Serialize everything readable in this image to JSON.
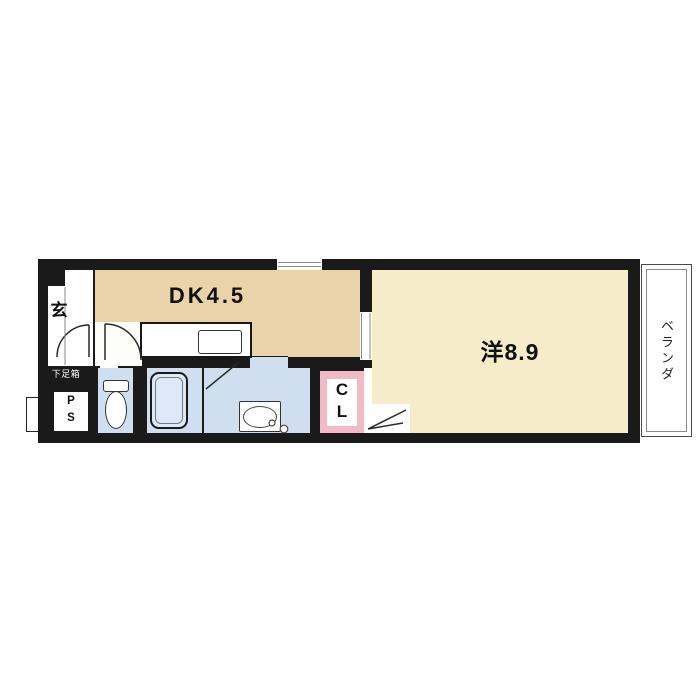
{
  "floorplan": {
    "rooms": {
      "genkan": {
        "label": "玄"
      },
      "dining_kitchen": {
        "label": "DK4.5"
      },
      "western_room": {
        "label": "洋8.9"
      },
      "veranda": {
        "label": "ベランダ"
      },
      "closet": {
        "letters": [
          "C",
          "L"
        ]
      },
      "pipe_space": {
        "letters": [
          "P",
          "S"
        ]
      },
      "shoe_box": {
        "label": "下足箱"
      }
    },
    "colors": {
      "background": "#ffffff",
      "wall": "#1a1a1a",
      "dk_floor": "#e8d3ab",
      "western_floor": "#f7ecc9",
      "wet_area": "#cfdfef",
      "tub": "#dde9f6",
      "closet_frame": "#f2bac5",
      "veranda_border": "#4a4a4a"
    }
  }
}
